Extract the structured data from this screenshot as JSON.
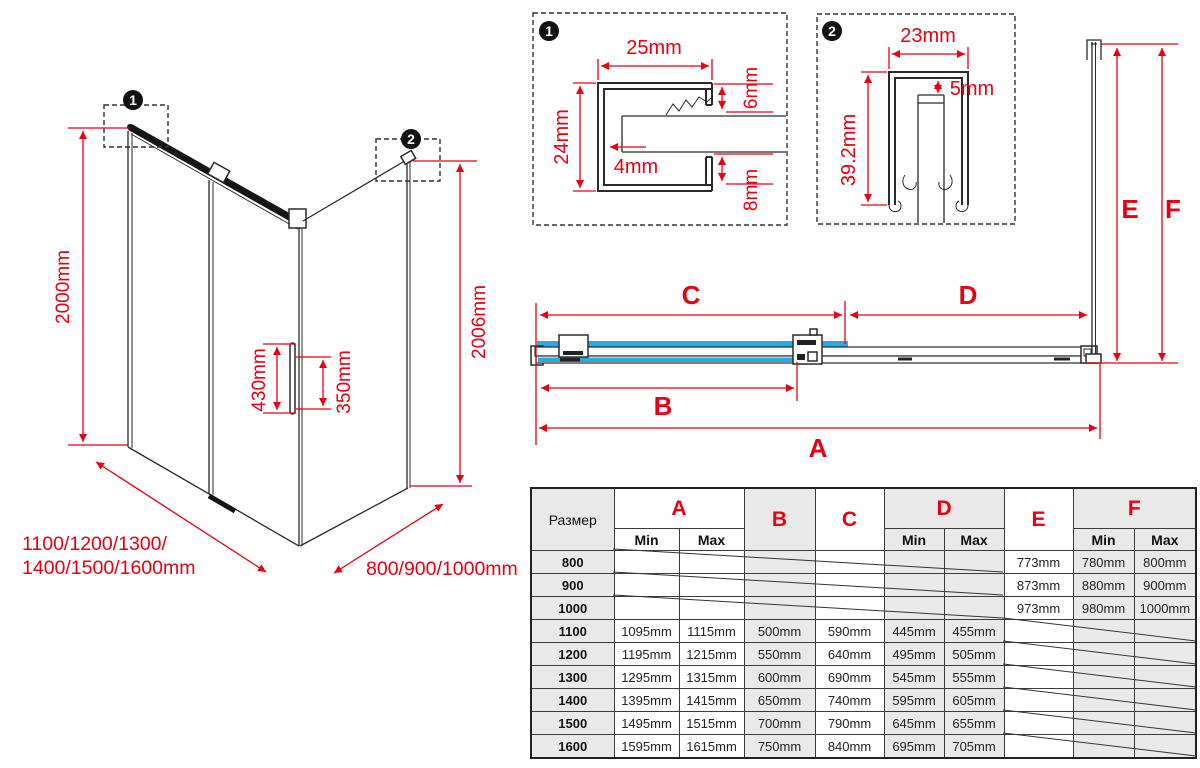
{
  "colors": {
    "red": "#e60012",
    "glass_blue": "#29abe2",
    "table_gray": "#e9e9e9"
  },
  "front_view": {
    "badge1": "1",
    "badge2": "2",
    "door_height": "2000mm",
    "side_panel_height": "2006mm",
    "handle_length": "430mm",
    "handle_hole_spacing": "350mm",
    "width_options_line1": "1100/1200/1300/",
    "width_options_line2": "1400/1500/1600mm",
    "depth_options": "800/900/1000mm"
  },
  "detail_1": {
    "badge": "1",
    "profile_width": "25mm",
    "profile_height": "24mm",
    "top_lip": "6mm",
    "glass_gap": "4mm",
    "bottom_lip": "8mm"
  },
  "detail_2": {
    "badge": "2",
    "profile_width": "23mm",
    "top_gap": "5mm",
    "profile_height": "39.2mm"
  },
  "plan_view": {
    "a": "A",
    "b": "B",
    "c": "C",
    "d": "D",
    "e": "E",
    "f": "F"
  },
  "table": {
    "size_label": "Размер",
    "min": "Min",
    "max": "Max",
    "letters": {
      "a": "A",
      "b": "B",
      "c": "C",
      "d": "D",
      "e": "E",
      "f": "F"
    },
    "rows": [
      {
        "size": "800",
        "a_min": "",
        "a_max": "",
        "b": "",
        "c": "",
        "d_min": "",
        "d_max": "",
        "e": "773mm",
        "f_min": "780mm",
        "f_max": "800mm"
      },
      {
        "size": "900",
        "a_min": "",
        "a_max": "",
        "b": "",
        "c": "",
        "d_min": "",
        "d_max": "",
        "e": "873mm",
        "f_min": "880mm",
        "f_max": "900mm"
      },
      {
        "size": "1000",
        "a_min": "",
        "a_max": "",
        "b": "",
        "c": "",
        "d_min": "",
        "d_max": "",
        "e": "973mm",
        "f_min": "980mm",
        "f_max": "1000mm"
      },
      {
        "size": "1100",
        "a_min": "1095mm",
        "a_max": "1115mm",
        "b": "500mm",
        "c": "590mm",
        "d_min": "445mm",
        "d_max": "455mm",
        "e": "",
        "f_min": "",
        "f_max": ""
      },
      {
        "size": "1200",
        "a_min": "1195mm",
        "a_max": "1215mm",
        "b": "550mm",
        "c": "640mm",
        "d_min": "495mm",
        "d_max": "505mm",
        "e": "",
        "f_min": "",
        "f_max": ""
      },
      {
        "size": "1300",
        "a_min": "1295mm",
        "a_max": "1315mm",
        "b": "600mm",
        "c": "690mm",
        "d_min": "545mm",
        "d_max": "555mm",
        "e": "",
        "f_min": "",
        "f_max": ""
      },
      {
        "size": "1400",
        "a_min": "1395mm",
        "a_max": "1415mm",
        "b": "650mm",
        "c": "740mm",
        "d_min": "595mm",
        "d_max": "605mm",
        "e": "",
        "f_min": "",
        "f_max": ""
      },
      {
        "size": "1500",
        "a_min": "1495mm",
        "a_max": "1515mm",
        "b": "700mm",
        "c": "790mm",
        "d_min": "645mm",
        "d_max": "655mm",
        "e": "",
        "f_min": "",
        "f_max": ""
      },
      {
        "size": "1600",
        "a_min": "1595mm",
        "a_max": "1615mm",
        "b": "750mm",
        "c": "840mm",
        "d_min": "695mm",
        "d_max": "705mm",
        "e": "",
        "f_min": "",
        "f_max": ""
      }
    ]
  }
}
